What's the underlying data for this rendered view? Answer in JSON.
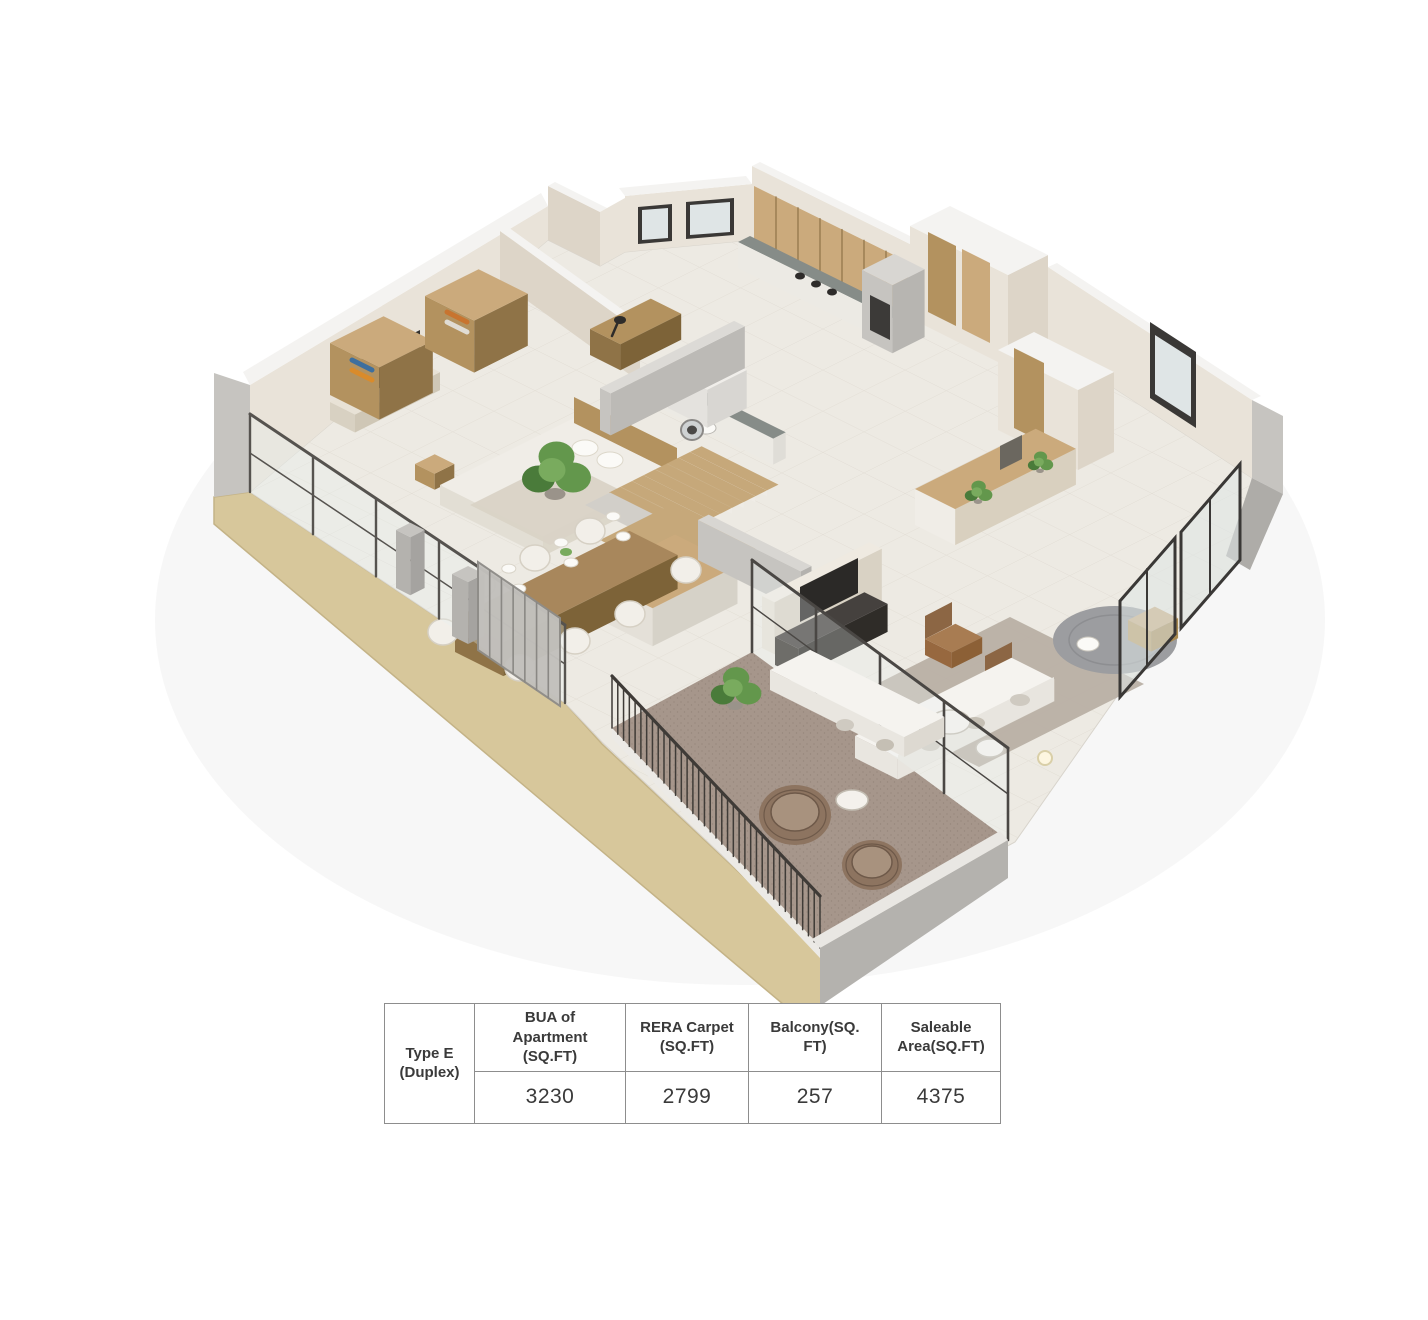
{
  "area_table": {
    "row_label": "Type E (Duplex)",
    "columns": [
      {
        "header": "BUA of Apartment (SQ.FT)",
        "value": "3230"
      },
      {
        "header": "RERA Carpet (SQ.FT)",
        "value": "2799"
      },
      {
        "header": "Balcony(SQ. FT)",
        "value": "257"
      },
      {
        "header": "Saleable Area(SQ.FT)",
        "value": "4375"
      }
    ]
  },
  "palette": {
    "background": "#ffffff",
    "floor": "#edeae3",
    "tile_line": "#ded9d0",
    "wall_cream": "#e9e3d9",
    "wall_cream_dark": "#ddd5c8",
    "wall_gray": "#c6c4c0",
    "wall_gray_dark": "#aeaca8",
    "wall_cap": "#f4f3f1",
    "plinth": "#d7c79b",
    "plinth_dark": "#c4b387",
    "wood": "#b3925f",
    "wood_light": "#cbaa7c",
    "wood_dark": "#8f7347",
    "counter": "#868c88",
    "stair": "#c6a87a",
    "white_furniture": "#f2efe9",
    "sofa": "#f5f3ef",
    "armchair": "#a87c52",
    "armchair_dark": "#8c6644",
    "rug": "#b7aea3",
    "round_rug": "#9c9da0",
    "balcony_carpet": "#a6968b",
    "tv": "#34322f",
    "railing": "#56534f",
    "railing_dark": "#3f3b37",
    "plant": "#63974c",
    "plant_dark": "#4a7b3a",
    "glass": "#dfe5e6",
    "window_frame": "#3a3836",
    "table_border": "#8d8d8d",
    "text": "#3a3a3a"
  }
}
